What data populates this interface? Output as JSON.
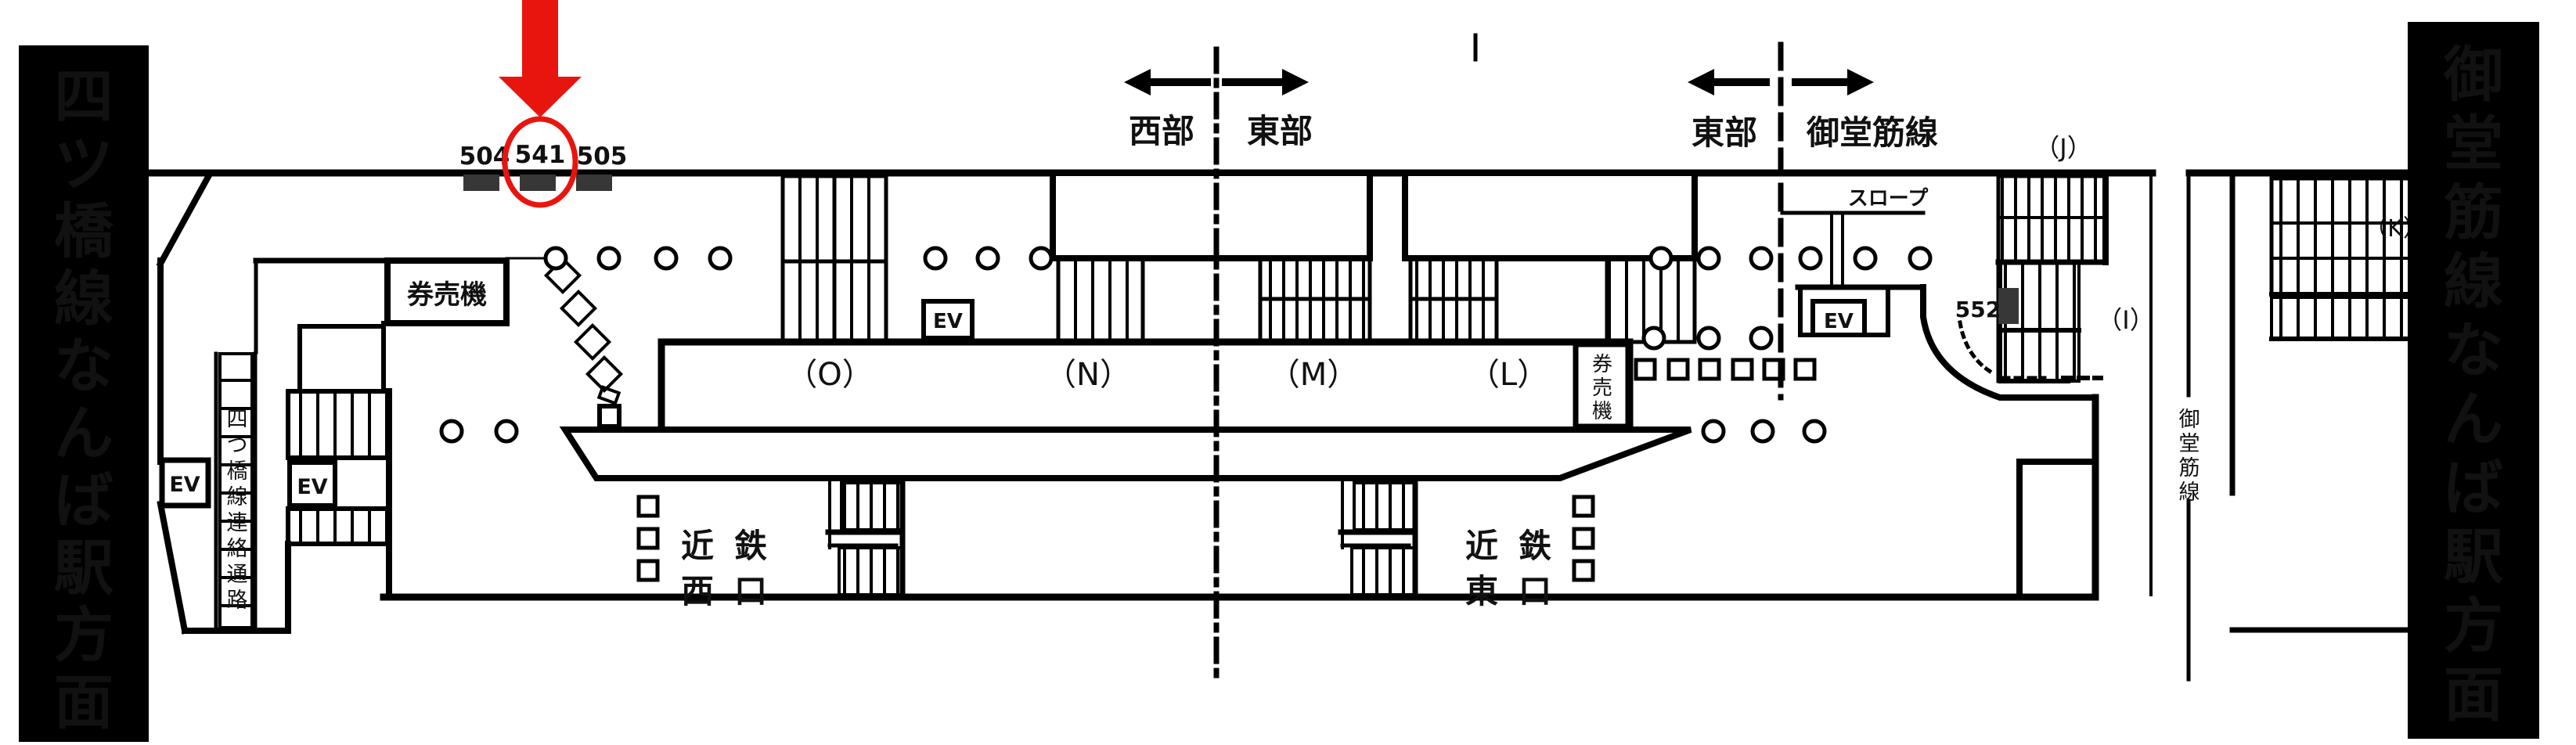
{
  "colors": {
    "red": "#e8150f",
    "gray": "#4d4d4d",
    "dark": "#373737",
    "black": "#000000",
    "white": "#ffffff"
  },
  "banners": {
    "left": "四ツ橋線なんば駅方面",
    "right": "御堂筋線なんば駅方面"
  },
  "ad_spots": {
    "s504": "504",
    "s541": "541",
    "s505": "505",
    "s552": "552"
  },
  "zone_signs": {
    "west": "西部",
    "east_center": "東部",
    "east": "東部",
    "midosuji": "御堂筋線"
  },
  "platform_sections": {
    "o": "（O）",
    "n": "（N）",
    "m": "（M）",
    "l": "（L）"
  },
  "stair_labels": {
    "j": "（J）",
    "i": "（I）",
    "k": "（K）"
  },
  "facilities": {
    "elevator": "EV",
    "ticket_machine_west": "券売機",
    "ticket_machine_east": "券売機",
    "slope": "スロープ",
    "passage": "四つ橋線連絡通路",
    "track_line": "御堂筋線"
  },
  "gates": {
    "west": [
      "近鉄",
      "西口"
    ],
    "east": [
      "近鉄",
      "東口"
    ]
  }
}
